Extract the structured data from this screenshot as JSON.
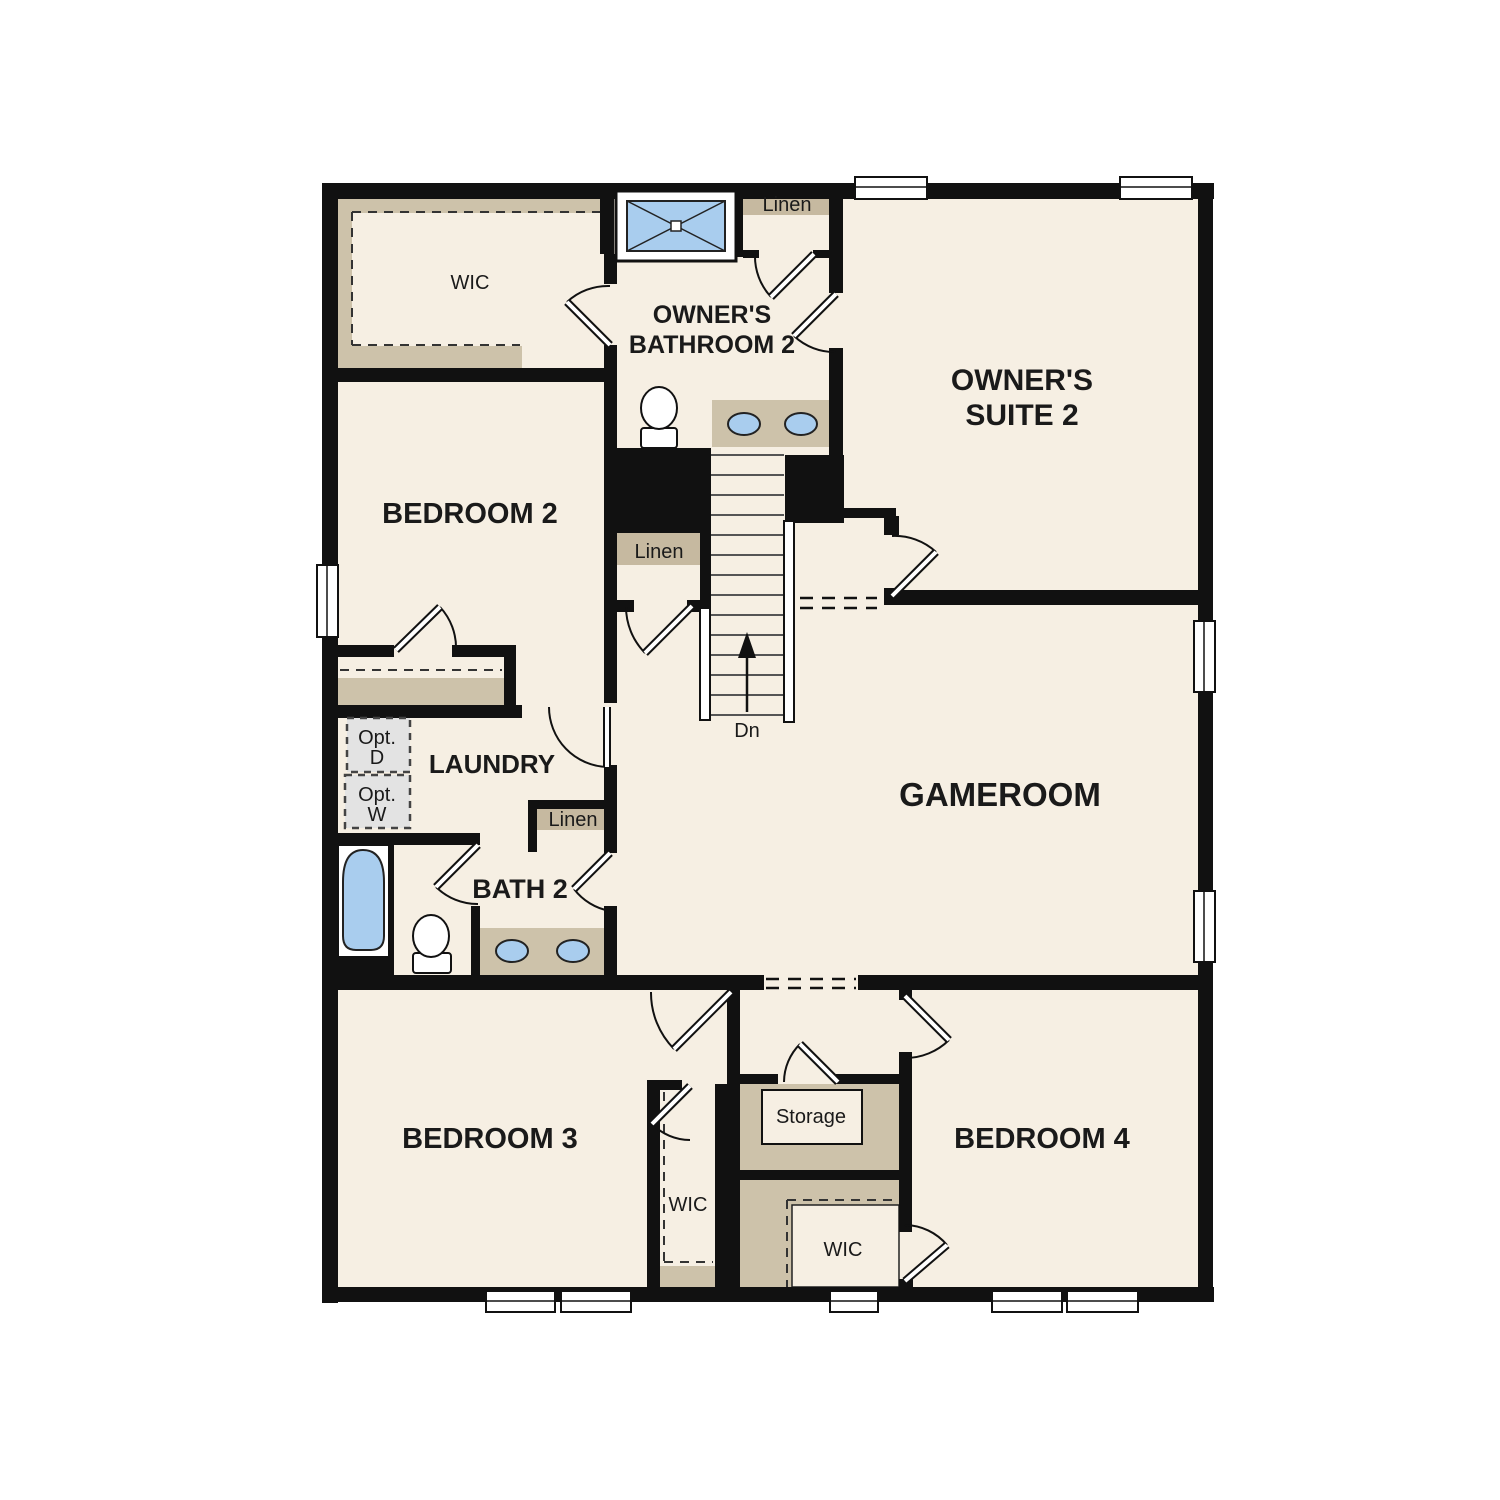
{
  "title": "Second floor residential floor plan",
  "colors": {
    "wall": "#111111",
    "floor": "#f6efe3",
    "closet": "#cdc2aa",
    "header": "#c6b9a0",
    "fixture_blue": "#a9cdee",
    "opt_gray": "#e3e3e3",
    "text": "#1a1a1a"
  },
  "labels": {
    "wic_owner": "WIC",
    "linen_top": "Linen",
    "owners_bath_1": "OWNER'S",
    "owners_bath_2": "BATHROOM 2",
    "owners_suite_1": "OWNER'S",
    "owners_suite_2": "SUITE 2",
    "bedroom2": "BEDROOM 2",
    "linen_mid": "Linen",
    "dn": "Dn",
    "laundry": "LAUNDRY",
    "opt_d_1": "Opt.",
    "opt_d_2": "D",
    "opt_w_1": "Opt.",
    "opt_w_2": "W",
    "linen_bath2": "Linen",
    "bath2": "BATH 2",
    "gameroom": "GAMEROOM",
    "bedroom3": "BEDROOM 3",
    "wic_bedroom3": "WIC",
    "storage": "Storage",
    "wic_bedroom4": "WIC",
    "bedroom4": "BEDROOM 4"
  }
}
